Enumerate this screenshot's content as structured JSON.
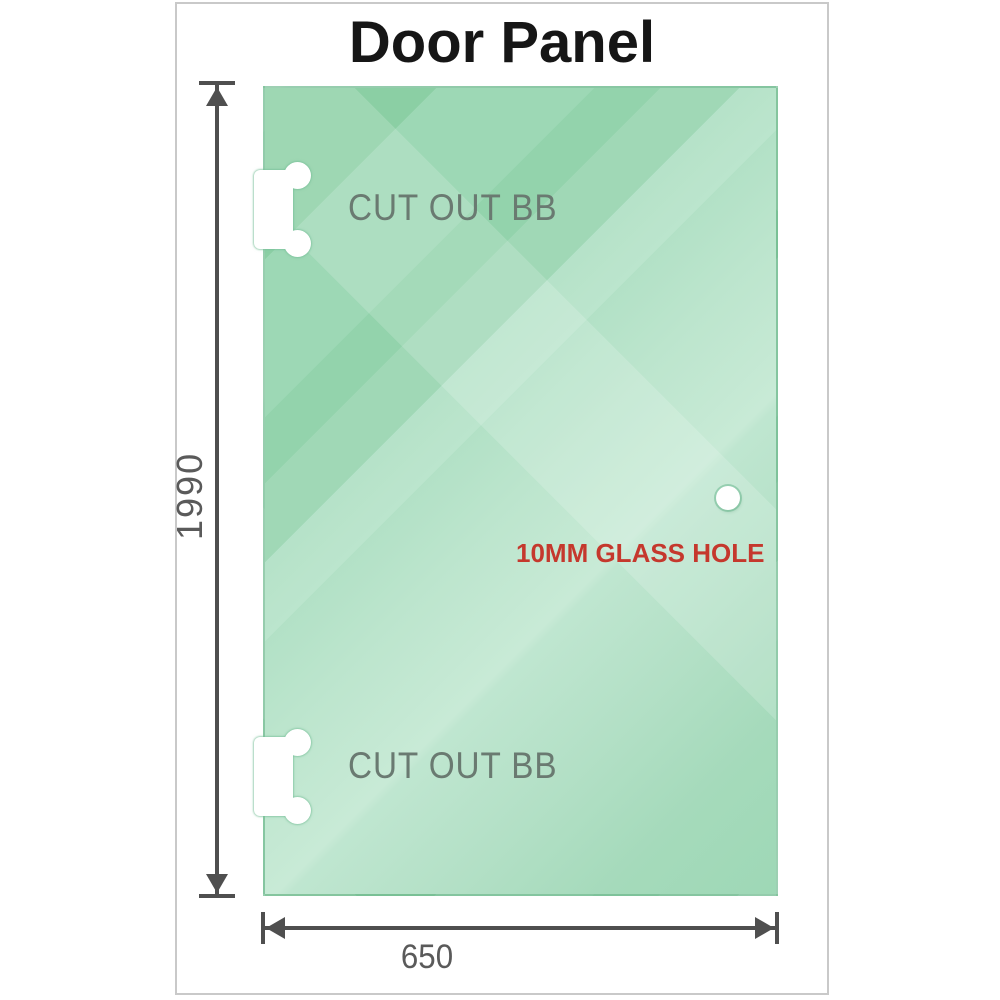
{
  "title": "Door Panel",
  "glass_panel": {
    "cutout_top_label": "CUT OUT BB",
    "cutout_bottom_label": "CUT OUT BB",
    "glass_hole_label": "10MM GLASS HOLE"
  },
  "dimensions": {
    "height_mm": "1990",
    "width_mm": "650"
  },
  "colors": {
    "glass_base": "#8ccfa5",
    "glass_highlight": "#c8ead6",
    "cutout_outline": "#74bd96",
    "dimension_line": "#4f4f4f",
    "dimension_text": "#5a5a5a",
    "cutout_label_text": "#6a7a71",
    "hole_label_text": "#c5382d",
    "frame_border": "#c9c9c9",
    "title_text": "#161616"
  }
}
